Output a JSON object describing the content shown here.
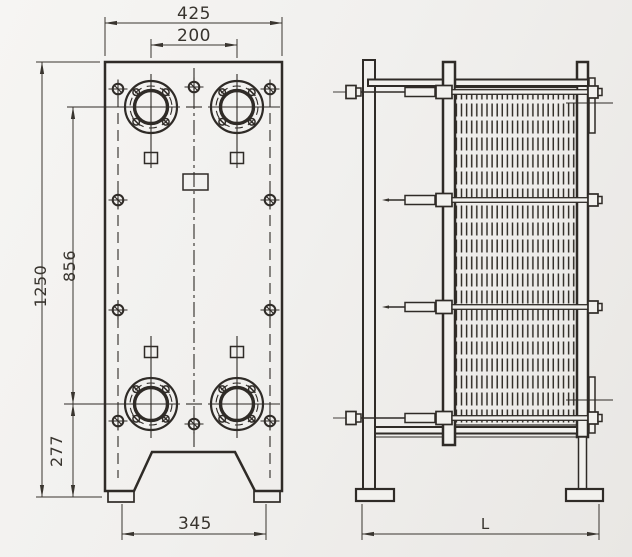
{
  "drawing": {
    "title": "plate-heat-exchanger-outline-drawing",
    "front_view": {
      "dim_width": "425",
      "dim_port_spacing": "200",
      "dim_height": "1250",
      "dim_port_vertical_spacing": "856",
      "dim_port_to_base": "277",
      "dim_foot_spacing": "345"
    },
    "side_view": {
      "dim_length": "L"
    },
    "colors": {
      "line": "#2f2b27",
      "dimension": "#39352f",
      "background": "#f1f0ee"
    }
  }
}
